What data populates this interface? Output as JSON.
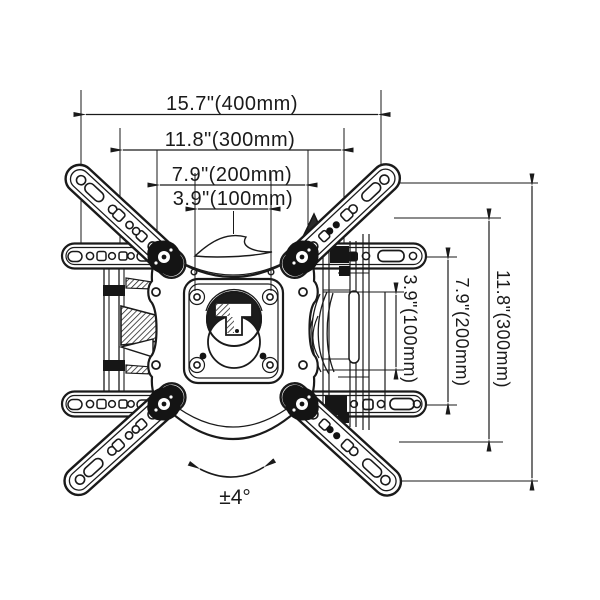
{
  "diagram": {
    "dim_h400": "15.7\"(400mm)",
    "dim_h300": "11.8\"(300mm)",
    "dim_h200": "7.9\"(200mm)",
    "dim_h100": "3.9\"(100mm)",
    "dim_v100": "3.9\"(100mm)",
    "dim_v200": "7.9\"(200mm)",
    "dim_v300": "11.8\"(300mm)",
    "tilt_label": "±4°"
  },
  "colors": {
    "line": "#1a1a1a",
    "background": "#ffffff"
  }
}
